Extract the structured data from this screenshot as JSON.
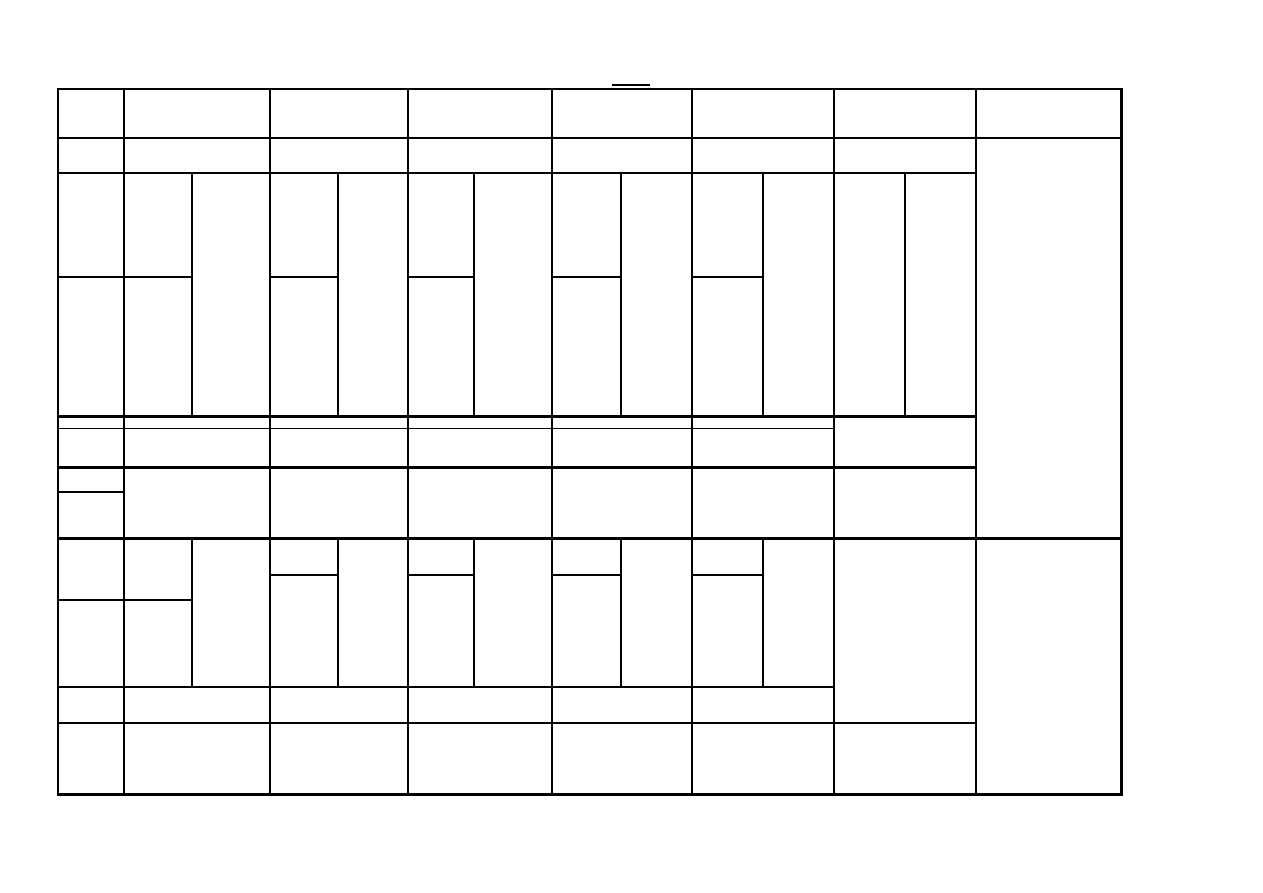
{
  "page": {
    "width": 1263,
    "height": 893,
    "background": "#ffffff"
  },
  "colors": {
    "line": "#000000"
  },
  "title_underline": {
    "x": 612,
    "y": 84,
    "width": 38,
    "height": 2
  },
  "table": {
    "x": 57,
    "y": 88,
    "right": 1123,
    "bottom": 796,
    "cell_text": "",
    "v_lines": [
      {
        "x": 57,
        "y1": 88,
        "y2": 796,
        "w": 2
      },
      {
        "x": 123,
        "y1": 88,
        "y2": 796,
        "w": 2
      },
      {
        "x": 191,
        "y1": 172,
        "y2": 417,
        "w": 2
      },
      {
        "x": 191,
        "y1": 537,
        "y2": 688,
        "w": 2
      },
      {
        "x": 269,
        "y1": 88,
        "y2": 796,
        "w": 2
      },
      {
        "x": 337,
        "y1": 172,
        "y2": 417,
        "w": 2
      },
      {
        "x": 337,
        "y1": 537,
        "y2": 688,
        "w": 2
      },
      {
        "x": 407,
        "y1": 88,
        "y2": 796,
        "w": 2
      },
      {
        "x": 473,
        "y1": 172,
        "y2": 417,
        "w": 2
      },
      {
        "x": 473,
        "y1": 537,
        "y2": 688,
        "w": 2
      },
      {
        "x": 551,
        "y1": 88,
        "y2": 796,
        "w": 2
      },
      {
        "x": 620,
        "y1": 172,
        "y2": 417,
        "w": 2
      },
      {
        "x": 620,
        "y1": 537,
        "y2": 688,
        "w": 2
      },
      {
        "x": 691,
        "y1": 88,
        "y2": 796,
        "w": 2
      },
      {
        "x": 762,
        "y1": 172,
        "y2": 417,
        "w": 2
      },
      {
        "x": 762,
        "y1": 537,
        "y2": 688,
        "w": 2
      },
      {
        "x": 833,
        "y1": 88,
        "y2": 796,
        "w": 2
      },
      {
        "x": 904,
        "y1": 172,
        "y2": 417,
        "w": 2
      },
      {
        "x": 975,
        "y1": 88,
        "y2": 796,
        "w": 2
      },
      {
        "x": 1120,
        "y1": 88,
        "y2": 796,
        "w": 3
      }
    ],
    "h_lines": [
      {
        "y": 88,
        "x1": 57,
        "x2": 1123,
        "w": 2
      },
      {
        "y": 137,
        "x1": 57,
        "x2": 1123,
        "w": 2
      },
      {
        "y": 172,
        "x1": 57,
        "x2": 977,
        "w": 2
      },
      {
        "y": 276,
        "x1": 57,
        "x2": 193,
        "w": 2
      },
      {
        "y": 276,
        "x1": 269,
        "x2": 339,
        "w": 2
      },
      {
        "y": 276,
        "x1": 407,
        "x2": 475,
        "w": 2
      },
      {
        "y": 276,
        "x1": 551,
        "x2": 622,
        "w": 2
      },
      {
        "y": 276,
        "x1": 691,
        "x2": 764,
        "w": 2
      },
      {
        "y": 415,
        "x1": 57,
        "x2": 977,
        "w": 3
      },
      {
        "y": 428,
        "x1": 57,
        "x2": 835,
        "w": 1
      },
      {
        "y": 466,
        "x1": 57,
        "x2": 977,
        "w": 3
      },
      {
        "y": 491,
        "x1": 57,
        "x2": 125,
        "w": 2
      },
      {
        "y": 537,
        "x1": 57,
        "x2": 1123,
        "w": 3
      },
      {
        "y": 574,
        "x1": 269,
        "x2": 339,
        "w": 2
      },
      {
        "y": 574,
        "x1": 407,
        "x2": 475,
        "w": 2
      },
      {
        "y": 574,
        "x1": 551,
        "x2": 622,
        "w": 2
      },
      {
        "y": 574,
        "x1": 691,
        "x2": 764,
        "w": 2
      },
      {
        "y": 599,
        "x1": 57,
        "x2": 193,
        "w": 2
      },
      {
        "y": 686,
        "x1": 57,
        "x2": 835,
        "w": 2
      },
      {
        "y": 722,
        "x1": 57,
        "x2": 977,
        "w": 2
      },
      {
        "y": 793,
        "x1": 57,
        "x2": 1123,
        "w": 3
      }
    ]
  }
}
